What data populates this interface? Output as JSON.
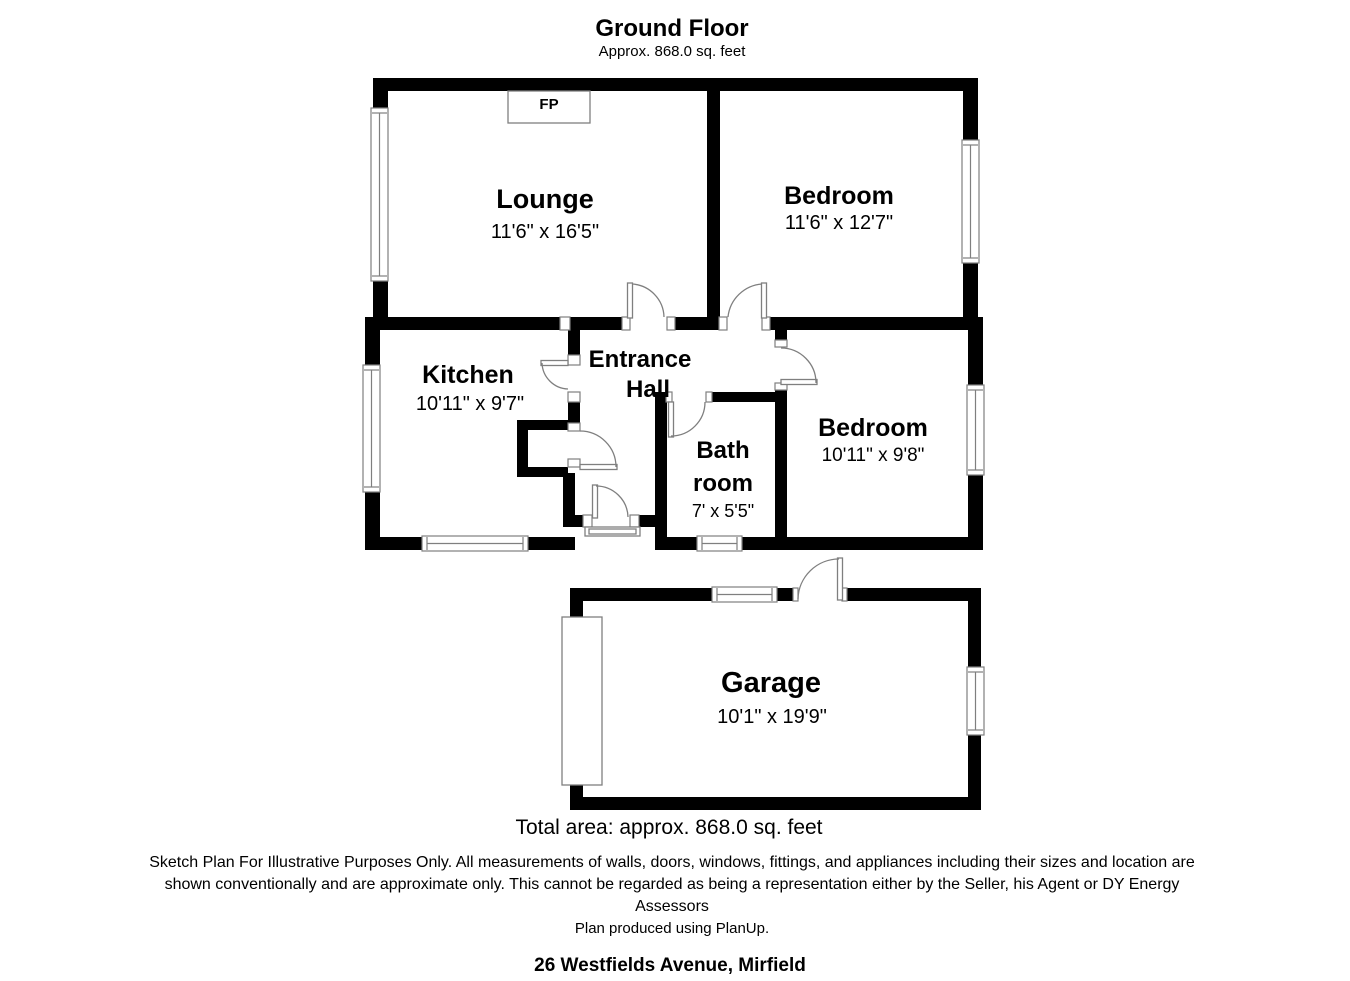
{
  "header": {
    "title": "Ground Floor",
    "subtitle": "Approx. 868.0 sq. feet"
  },
  "labels": {
    "fireplace": "FP"
  },
  "rooms": {
    "lounge": {
      "name": "Lounge",
      "dims": "11'6\" x 16'5\""
    },
    "bedroom1": {
      "name": "Bedroom",
      "dims": "11'6\" x 12'7\""
    },
    "kitchen": {
      "name": "Kitchen",
      "dims": "10'11\" x 9'7\""
    },
    "entrance_hall": {
      "line1": "Entrance",
      "line2": "Hall"
    },
    "bathroom": {
      "line1": "Bath",
      "line2": "room",
      "dims": "7' x 5'5\""
    },
    "bedroom2": {
      "name": "Bedroom",
      "dims": "10'11\" x 9'8\""
    },
    "garage": {
      "name": "Garage",
      "dims": "10'1\" x 19'9\""
    }
  },
  "footer": {
    "total_area": "Total area: approx. 868.0 sq. feet",
    "disclaimer_line1": "Sketch Plan For Illustrative Purposes Only. All measurements of walls, doors, windows, fittings, and appliances including their sizes and location are",
    "disclaimer_line2": "shown conventionally and are approximate only. This cannot be regarded as being a representation either by the Seller, his Agent or DY Energy",
    "disclaimer_line3": "Assessors",
    "produced_by": "Plan produced using PlanUp.",
    "address": "26 Westfields Avenue, Mirfield"
  },
  "colors": {
    "wall": "#000000",
    "detail_line": "#7f7f7f",
    "background": "#ffffff"
  }
}
